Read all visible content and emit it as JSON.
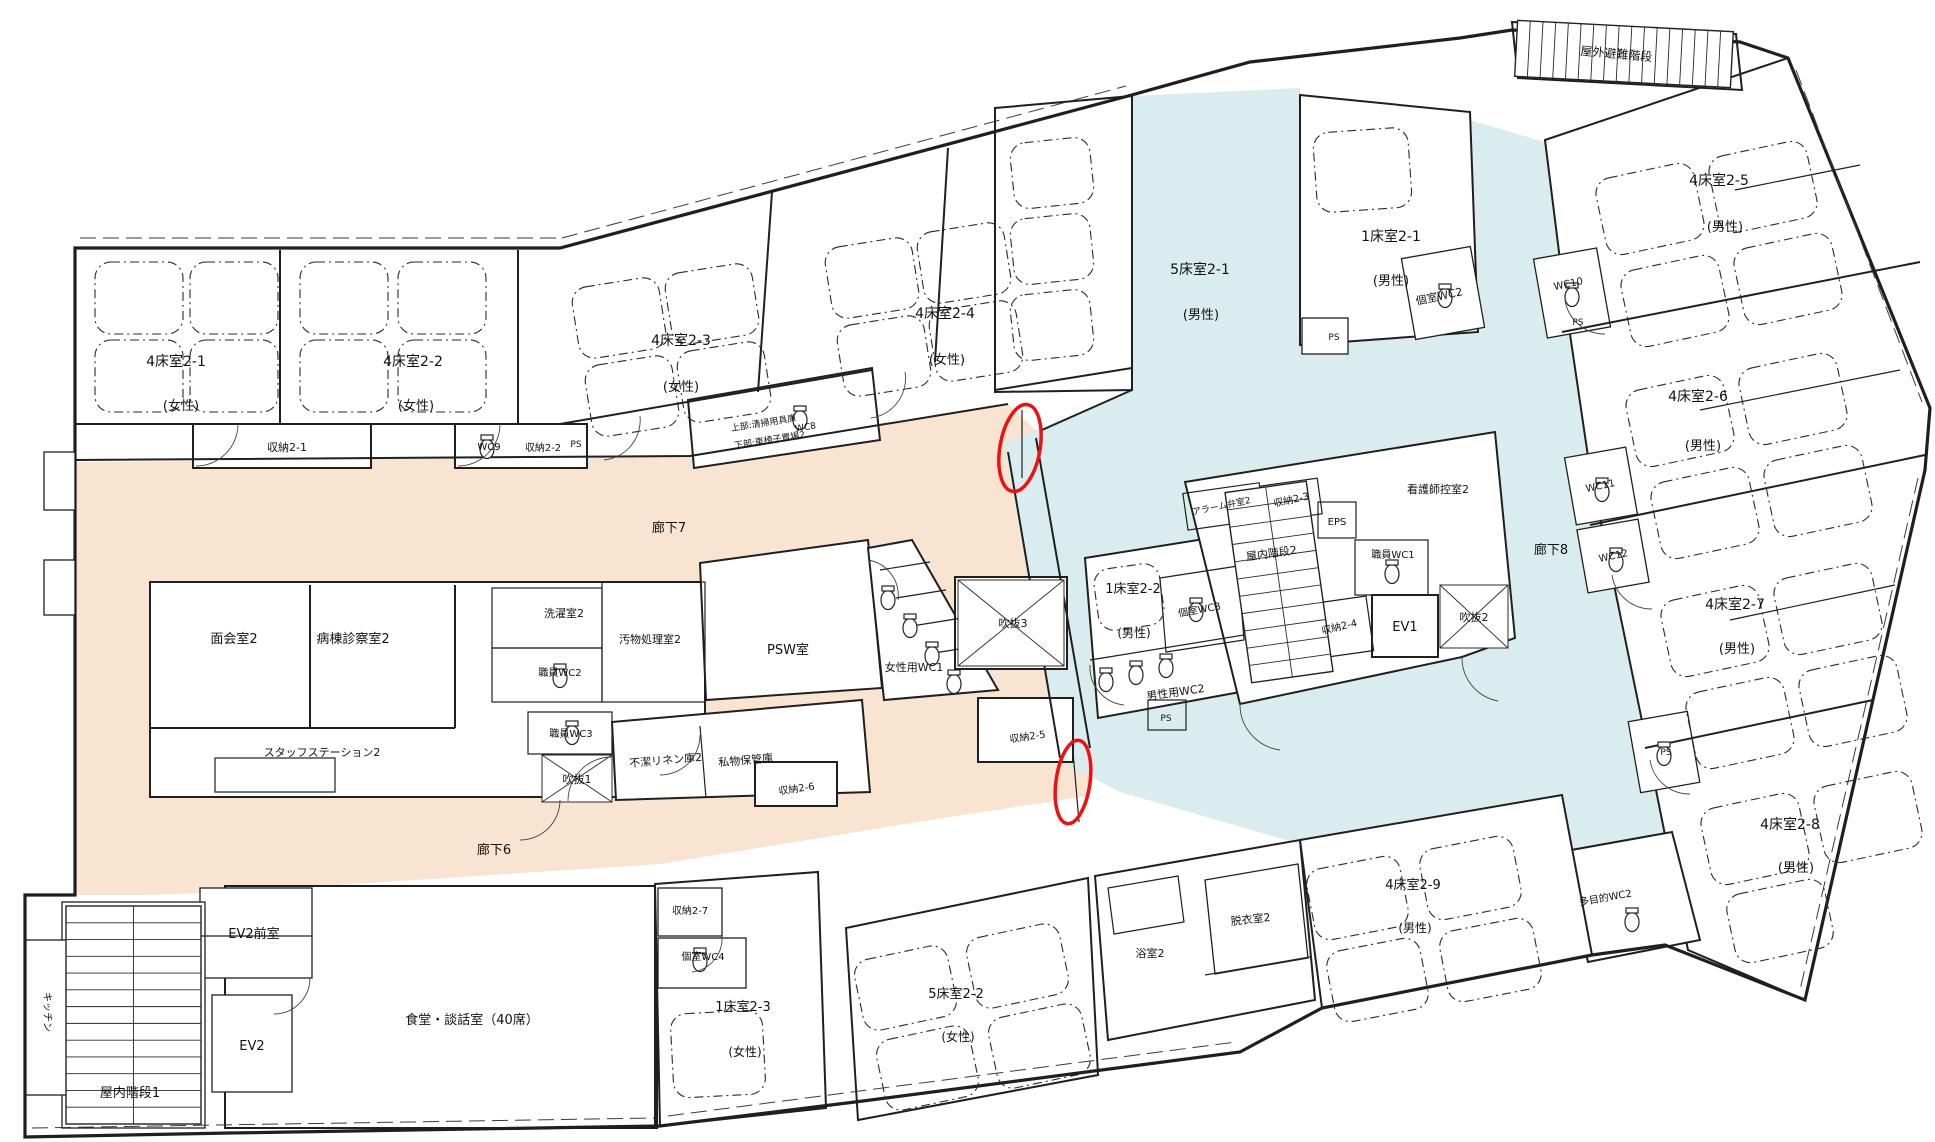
{
  "meta": {
    "document_type": "hospital-ward-floor-plan",
    "language": "ja",
    "floor": "2F ward plan with corridors highlighted and two doors circled in red"
  },
  "colors": {
    "corridor_west_highlight": "#F8E4D0",
    "corridor_east_highlight": "#DAEDEE",
    "door_marker": "#EE1111",
    "wall": "#1f1f1f",
    "background": "#ffffff"
  },
  "corridors": [
    {
      "id": "corridor-7",
      "label": "廊下7",
      "highlight": "#F8E4D0"
    },
    {
      "id": "corridor-6",
      "label": "廊下6",
      "highlight": "#F8E4D0"
    },
    {
      "id": "corridor-8",
      "label": "廊下8",
      "highlight": "#DAEDEE"
    }
  ],
  "markers": [
    {
      "id": "door-highlight-1",
      "shape": "ellipse",
      "color": "#EE1111",
      "x": 1020,
      "y": 448,
      "rx": 20,
      "ry": 44,
      "rot": 10
    },
    {
      "id": "door-highlight-2",
      "shape": "ellipse",
      "color": "#EE1111",
      "x": 1073,
      "y": 782,
      "rx": 17,
      "ry": 42,
      "rot": 8
    }
  ],
  "floor_plan": {
    "labels": [
      {
        "id": "room-4bed-2-1",
        "text": "4床室2-1",
        "x": 176,
        "y": 366,
        "s": 14,
        "rot": 0
      },
      {
        "id": "room-4bed-2-1-gender",
        "text": "(女性)",
        "x": 181,
        "y": 410,
        "s": 13,
        "rot": 0
      },
      {
        "id": "room-4bed-2-2",
        "text": "4床室2-2",
        "x": 413,
        "y": 366,
        "s": 14,
        "rot": 0
      },
      {
        "id": "room-4bed-2-2-gender",
        "text": "(女性)",
        "x": 416,
        "y": 410,
        "s": 13,
        "rot": 0
      },
      {
        "id": "room-4bed-2-3",
        "text": "4床室2-3",
        "x": 681,
        "y": 345,
        "s": 14,
        "rot": 0
      },
      {
        "id": "room-4bed-2-3-gender",
        "text": "(女性)",
        "x": 681,
        "y": 391,
        "s": 13,
        "rot": 0
      },
      {
        "id": "room-4bed-2-4",
        "text": "4床室2-4",
        "x": 945,
        "y": 318,
        "s": 14,
        "rot": 0
      },
      {
        "id": "room-4bed-2-4-gender",
        "text": "(女性)",
        "x": 947,
        "y": 364,
        "s": 13,
        "rot": 0
      },
      {
        "id": "room-5bed-2-1",
        "text": "5床室2-1",
        "x": 1200,
        "y": 274,
        "s": 14,
        "rot": 0
      },
      {
        "id": "room-5bed-2-1-gender",
        "text": "(男性)",
        "x": 1201,
        "y": 319,
        "s": 13,
        "rot": 0
      },
      {
        "id": "room-1bed-2-1",
        "text": "1床室2-1",
        "x": 1391,
        "y": 241,
        "s": 14,
        "rot": 0
      },
      {
        "id": "room-1bed-2-1-gender",
        "text": "(男性)",
        "x": 1391,
        "y": 285,
        "s": 13,
        "rot": 0
      },
      {
        "id": "wc-private-2",
        "text": "個室WC2",
        "x": 1440,
        "y": 300,
        "s": 11,
        "rot": -12
      },
      {
        "id": "outdoor-escape-stair",
        "text": "屋外避難階段",
        "x": 1616,
        "y": 58,
        "s": 12,
        "rot": 5
      },
      {
        "id": "room-4bed-2-5",
        "text": "4床室2-5",
        "x": 1719,
        "y": 185,
        "s": 14,
        "rot": 0
      },
      {
        "id": "room-4bed-2-5-gender",
        "text": "(男性)",
        "x": 1725,
        "y": 231,
        "s": 13,
        "rot": 0
      },
      {
        "id": "wc-10",
        "text": "WC10",
        "x": 1569,
        "y": 287,
        "s": 10,
        "rot": -12
      },
      {
        "id": "ps-1",
        "text": "PS",
        "x": 1578,
        "y": 325,
        "s": 9,
        "rot": 0
      },
      {
        "id": "room-4bed-2-6",
        "text": "4床室2-6",
        "x": 1698,
        "y": 401,
        "s": 14,
        "rot": 0
      },
      {
        "id": "room-4bed-2-6-gender",
        "text": "(男性)",
        "x": 1703,
        "y": 450,
        "s": 13,
        "rot": 0
      },
      {
        "id": "wc-11",
        "text": "WC11",
        "x": 1601,
        "y": 489,
        "s": 10,
        "rot": -12
      },
      {
        "id": "wc-12",
        "text": "WC12",
        "x": 1614,
        "y": 559,
        "s": 10,
        "rot": -12
      },
      {
        "id": "room-4bed-2-7",
        "text": "4床室2-7",
        "x": 1735,
        "y": 609,
        "s": 14,
        "rot": 0
      },
      {
        "id": "room-4bed-2-7-gender",
        "text": "(男性)",
        "x": 1737,
        "y": 653,
        "s": 13,
        "rot": 0
      },
      {
        "id": "ps-2",
        "text": "PS",
        "x": 1666,
        "y": 755,
        "s": 9,
        "rot": 0
      },
      {
        "id": "room-4bed-2-8",
        "text": "4床室2-8",
        "x": 1790,
        "y": 829,
        "s": 14,
        "rot": 0
      },
      {
        "id": "room-4bed-2-8-gender",
        "text": "(男性)",
        "x": 1796,
        "y": 872,
        "s": 13,
        "rot": 0
      },
      {
        "id": "wc-multipurpose",
        "text": "多目的WC2",
        "x": 1606,
        "y": 901,
        "s": 10,
        "rot": -10
      },
      {
        "id": "storage-2-1",
        "text": "収納2-1",
        "x": 287,
        "y": 451,
        "s": 11,
        "rot": 0
      },
      {
        "id": "wc-9",
        "text": "WC9",
        "x": 489,
        "y": 450,
        "s": 10,
        "rot": 0
      },
      {
        "id": "storage-2-2",
        "text": "収納2-2",
        "x": 543,
        "y": 451,
        "s": 10,
        "rot": 0
      },
      {
        "id": "ps-3",
        "text": "PS",
        "x": 576,
        "y": 447,
        "s": 9,
        "rot": 0
      },
      {
        "id": "note-upper",
        "text": "上部:清掃用具庫",
        "x": 764,
        "y": 426,
        "s": 9,
        "rot": -9
      },
      {
        "id": "note-lower",
        "text": "下部:車椅子置場2",
        "x": 770,
        "y": 443,
        "s": 9,
        "rot": -9
      },
      {
        "id": "corridor-7-label",
        "text": "廊下7",
        "x": 669,
        "y": 532,
        "s": 13,
        "rot": 0
      },
      {
        "id": "meeting-room-2",
        "text": "面会室2",
        "x": 234,
        "y": 643,
        "s": 13,
        "rot": 0
      },
      {
        "id": "ward-exam-room-2",
        "text": "病棟診察室2",
        "x": 353,
        "y": 643,
        "s": 13,
        "rot": 0
      },
      {
        "id": "laundry-room-2",
        "text": "洗濯室2",
        "x": 564,
        "y": 617,
        "s": 11,
        "rot": 0
      },
      {
        "id": "staff-wc-2",
        "text": "職員WC2",
        "x": 560,
        "y": 676,
        "s": 10,
        "rot": 0
      },
      {
        "id": "soiled-material-room-2",
        "text": "汚物処理室2",
        "x": 650,
        "y": 643,
        "s": 11,
        "rot": 0
      },
      {
        "id": "psw-room",
        "text": "PSW室",
        "x": 788,
        "y": 654,
        "s": 13,
        "rot": 0
      },
      {
        "id": "female-wc-1",
        "text": "女性用WC1",
        "x": 914,
        "y": 671,
        "s": 11,
        "rot": 0
      },
      {
        "id": "void-3",
        "text": "吹抜3",
        "x": 1013,
        "y": 627,
        "s": 11,
        "rot": 0
      },
      {
        "id": "staff-station-2",
        "text": "スタッフステーション2",
        "x": 322,
        "y": 756,
        "s": 11,
        "rot": 0
      },
      {
        "id": "staff-wc-3",
        "text": "職員WC3",
        "x": 571,
        "y": 737,
        "s": 10,
        "rot": 0
      },
      {
        "id": "void-1",
        "text": "吹抜1",
        "x": 577,
        "y": 783,
        "s": 11,
        "rot": 0
      },
      {
        "id": "unclean-linen-2",
        "text": "不潔リネン庫2",
        "x": 666,
        "y": 764,
        "s": 11,
        "rot": -5
      },
      {
        "id": "personal-storage",
        "text": "私物保管庫",
        "x": 746,
        "y": 764,
        "s": 11,
        "rot": -5
      },
      {
        "id": "storage-2-6",
        "text": "収納2-6",
        "x": 797,
        "y": 792,
        "s": 10,
        "rot": -8
      },
      {
        "id": "corridor-6-label",
        "text": "廊下6",
        "x": 494,
        "y": 854,
        "s": 13,
        "rot": 0
      },
      {
        "id": "storage-2-5",
        "text": "収納2-5",
        "x": 1028,
        "y": 740,
        "s": 10,
        "rot": -8
      },
      {
        "id": "room-1bed-2-2",
        "text": "1床室2-2",
        "x": 1133,
        "y": 593,
        "s": 13,
        "rot": 0
      },
      {
        "id": "room-1bed-2-2-gender",
        "text": "(男性)",
        "x": 1134,
        "y": 637,
        "s": 12,
        "rot": 0
      },
      {
        "id": "wc-private-3",
        "text": "個室WC3",
        "x": 1200,
        "y": 613,
        "s": 10,
        "rot": -10
      },
      {
        "id": "male-wc-2",
        "text": "男性用WC2",
        "x": 1176,
        "y": 696,
        "s": 11,
        "rot": -8
      },
      {
        "id": "ps-4",
        "text": "PS",
        "x": 1166,
        "y": 721,
        "s": 9,
        "rot": 0
      },
      {
        "id": "alarm-valve-room-2",
        "text": "アラーム弁室2",
        "x": 1222,
        "y": 509,
        "s": 9,
        "rot": -12
      },
      {
        "id": "storage-2-3",
        "text": "収納2-3",
        "x": 1292,
        "y": 503,
        "s": 10,
        "rot": -12
      },
      {
        "id": "eps",
        "text": "EPS",
        "x": 1337,
        "y": 525,
        "s": 10,
        "rot": 0
      },
      {
        "id": "nurse-lounge-2",
        "text": "看護師控室2",
        "x": 1438,
        "y": 493,
        "s": 11,
        "rot": 0
      },
      {
        "id": "staff-wc-1",
        "text": "職員WC1",
        "x": 1393,
        "y": 558,
        "s": 10,
        "rot": 0
      },
      {
        "id": "indoor-stair-2",
        "text": "屋内階段2",
        "x": 1272,
        "y": 557,
        "s": 11,
        "rot": -8
      },
      {
        "id": "storage-2-4",
        "text": "収納2-4",
        "x": 1340,
        "y": 630,
        "s": 10,
        "rot": -13
      },
      {
        "id": "ev-1",
        "text": "EV1",
        "x": 1405,
        "y": 631,
        "s": 13,
        "rot": 0
      },
      {
        "id": "void-2",
        "text": "吹抜2",
        "x": 1474,
        "y": 621,
        "s": 11,
        "rot": 0
      },
      {
        "id": "corridor-8-label",
        "text": "廊下8",
        "x": 1551,
        "y": 554,
        "s": 13,
        "rot": 0
      },
      {
        "id": "ev2-anteroom",
        "text": "EV2前室",
        "x": 254,
        "y": 938,
        "s": 13,
        "rot": 0
      },
      {
        "id": "ev-2",
        "text": "EV2",
        "x": 252,
        "y": 1050,
        "s": 13,
        "rot": 0
      },
      {
        "id": "indoor-stair-1",
        "text": "屋内階段1",
        "x": 130,
        "y": 1097,
        "s": 13,
        "rot": 0
      },
      {
        "id": "kitchen",
        "text": "キッチン",
        "x": 44,
        "y": 1012,
        "s": 10,
        "rot": 90
      },
      {
        "id": "dining-lounge",
        "text": "食堂・談話室（40席）",
        "x": 472,
        "y": 1024,
        "s": 13,
        "rot": 0
      },
      {
        "id": "storage-2-7",
        "text": "収納2-7",
        "x": 690,
        "y": 914,
        "s": 10,
        "rot": 0
      },
      {
        "id": "wc-private-4",
        "text": "個室WC4",
        "x": 703,
        "y": 960,
        "s": 10,
        "rot": 0
      },
      {
        "id": "room-1bed-2-3",
        "text": "1床室2-3",
        "x": 743,
        "y": 1011,
        "s": 13,
        "rot": 0
      },
      {
        "id": "room-1bed-2-3-gender",
        "text": "(女性)",
        "x": 745,
        "y": 1056,
        "s": 12,
        "rot": 0
      },
      {
        "id": "room-5bed-2-2",
        "text": "5床室2-2",
        "x": 956,
        "y": 998,
        "s": 13,
        "rot": 0
      },
      {
        "id": "room-5bed-2-2-gender",
        "text": "(女性)",
        "x": 958,
        "y": 1041,
        "s": 12,
        "rot": 0
      },
      {
        "id": "bath-room-2",
        "text": "浴室2",
        "x": 1150,
        "y": 957,
        "s": 11,
        "rot": 0
      },
      {
        "id": "undressing-room-2",
        "text": "脱衣室2",
        "x": 1251,
        "y": 923,
        "s": 11,
        "rot": -6
      },
      {
        "id": "room-4bed-2-9",
        "text": "4床室2-9",
        "x": 1413,
        "y": 889,
        "s": 13,
        "rot": 0
      },
      {
        "id": "room-4bed-2-9-gender",
        "text": "(男性)",
        "x": 1415,
        "y": 932,
        "s": 12,
        "rot": 0
      },
      {
        "id": "ps-5",
        "text": "PS",
        "x": 1334,
        "y": 340,
        "s": 9,
        "rot": 0
      },
      {
        "id": "wc-8",
        "text": "WC8",
        "x": 806,
        "y": 430,
        "s": 9,
        "rot": -9
      }
    ]
  }
}
